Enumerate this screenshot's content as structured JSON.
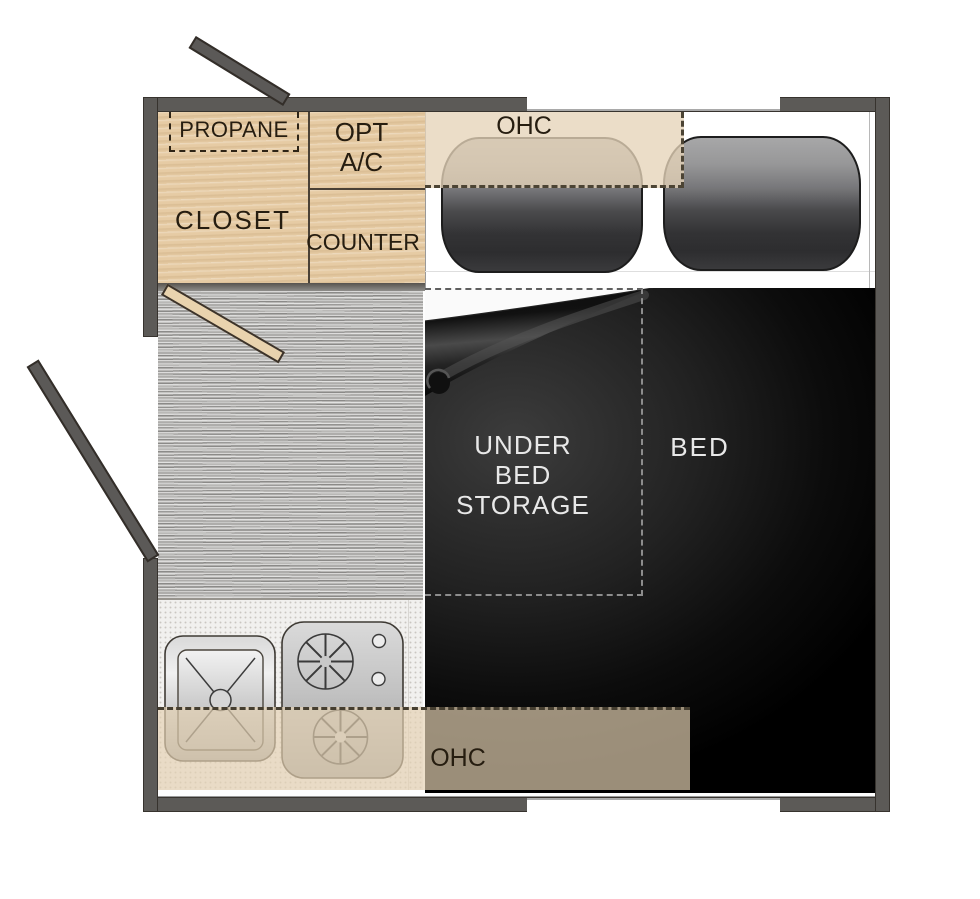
{
  "floorplan": {
    "labels": {
      "propane": "PROPANE",
      "closet": "CLOSET",
      "opt_ac": [
        "OPT",
        "A/C"
      ],
      "counter": "COUNTER",
      "ohc_top": "OHC",
      "ohc_bottom": "OHC",
      "under_bed_storage": [
        "UNDER",
        "BED",
        "STORAGE"
      ],
      "bed": "BED"
    },
    "colors": {
      "wall": "#5c5a57",
      "cabinet_wood": "#e6cba4",
      "ohc_overlay": "#e3d0b2",
      "carpet": "#aeadab",
      "bed_dark": "#0c0c0c",
      "label_dark": "#261d10",
      "label_light": "#e8e8e8"
    }
  }
}
